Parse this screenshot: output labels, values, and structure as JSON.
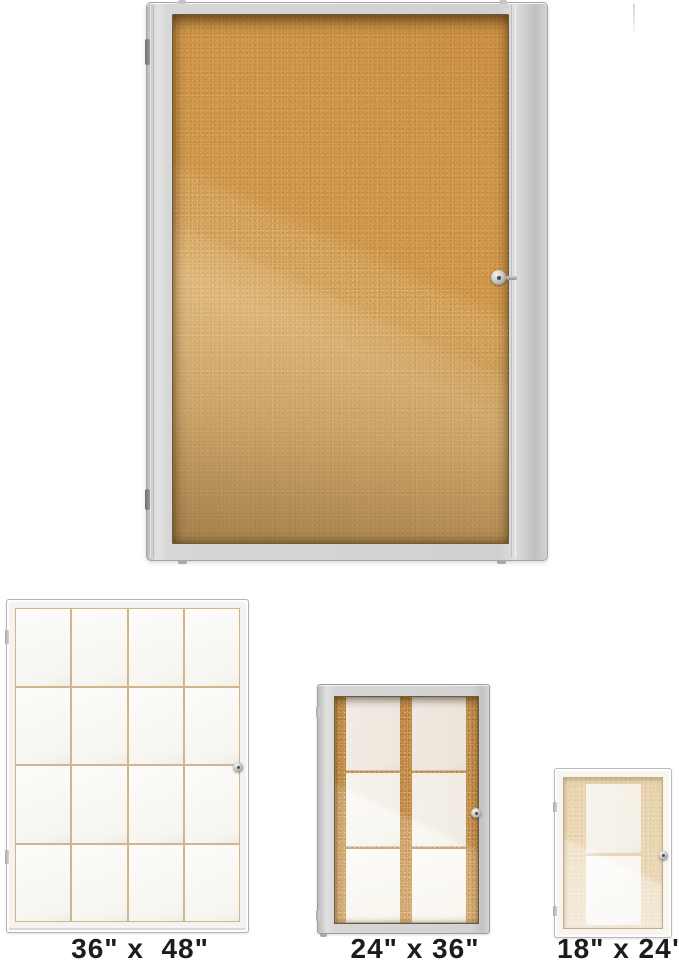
{
  "product": {
    "name": "enclosed-cork-bulletin-board",
    "icons": {
      "lock": "keyhole-lock",
      "hinge": "door-hinge"
    },
    "colors": {
      "hero_frame": "#d2d2d2",
      "hero_cork_light": "#dfbc86",
      "hero_cork_dark": "#cc8f3f",
      "variant_24x36_cork": "#c6914c",
      "variant_18x24_cork": "#ecdaba",
      "paper": "#f7f5f0",
      "label_text": "#1c1c1c"
    }
  },
  "variants": [
    {
      "id": "36x48",
      "label": "36\" x  48\""
    },
    {
      "id": "24x36",
      "label": "24\" x 36\""
    },
    {
      "id": "18x24",
      "label": "18\" x 24\""
    }
  ]
}
